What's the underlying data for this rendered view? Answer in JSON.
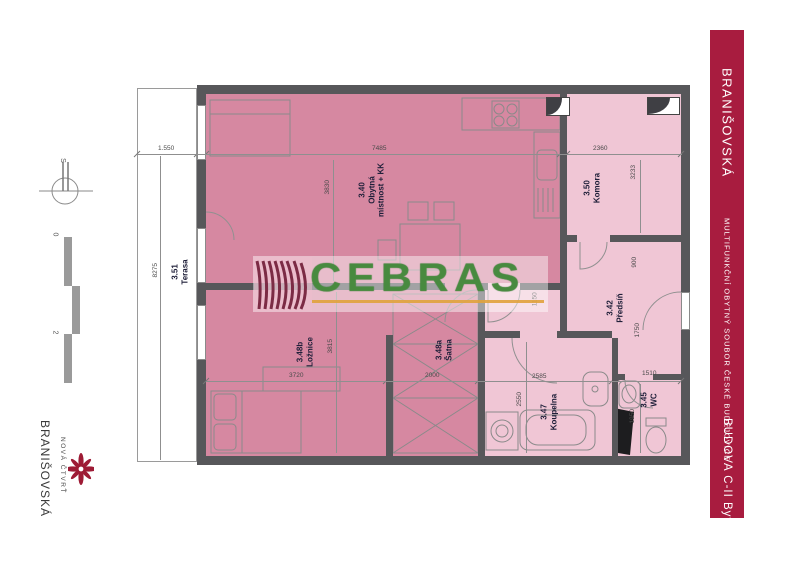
{
  "sidebar": {
    "project": "BRANIŠOVSKÁ",
    "subtitle": "MULTIFUNKČNÍ OBYTNÝ SOUBOR ČESKÉ BUDĚJOVICE",
    "unit": "BUDOVA C-II  Byt 94",
    "color": "#A81C3F"
  },
  "watermark": {
    "text": "CEBRAS",
    "green": "#4E9143",
    "underline": "#E0A23C"
  },
  "logo": {
    "line1": "NOVÁ ČTVRŤ",
    "line2": "BRANIŠOVSKÁ"
  },
  "compass": {
    "north": "S"
  },
  "scalebar": {
    "start": "0",
    "end": "2"
  },
  "rooms": {
    "living": {
      "num": "3.40",
      "name": "Obytná",
      "name2": "místnost + KK"
    },
    "komora": {
      "num": "3.50",
      "name": "Komora"
    },
    "predsin": {
      "num": "3.42",
      "name": "Předsíň"
    },
    "loznice": {
      "num": "3.48b",
      "name": "Ložnice"
    },
    "satna": {
      "num": "3.48a",
      "name": "Šatna"
    },
    "koupelna": {
      "num": "3.47",
      "name": "Koupelna"
    },
    "wc": {
      "num": "3.45",
      "name": "WC"
    },
    "terasa": {
      "num": "3.51",
      "name": "Terasa"
    }
  },
  "dims": {
    "terrace_w": "1.550",
    "living_w": "7485",
    "komora_w": "2360",
    "terrace_h": "8275",
    "living_h": "3830",
    "komora_h": "3233",
    "hall_top": "900",
    "hall_door": "1750",
    "hall_w": "1150",
    "loznice_h": "3815",
    "bedroom_w": "3720",
    "satna_w": "2000",
    "koupelna_w": "2585",
    "koupelna_h": "2550",
    "wc_w": "1510",
    "wc_h": "1950"
  },
  "colors": {
    "wall": "#57575A",
    "room_dark_pink": "#D688A1",
    "room_light_pink": "#F0C6D5",
    "sidebar_red": "#A81C3F",
    "logo_red": "#9E1B35"
  }
}
